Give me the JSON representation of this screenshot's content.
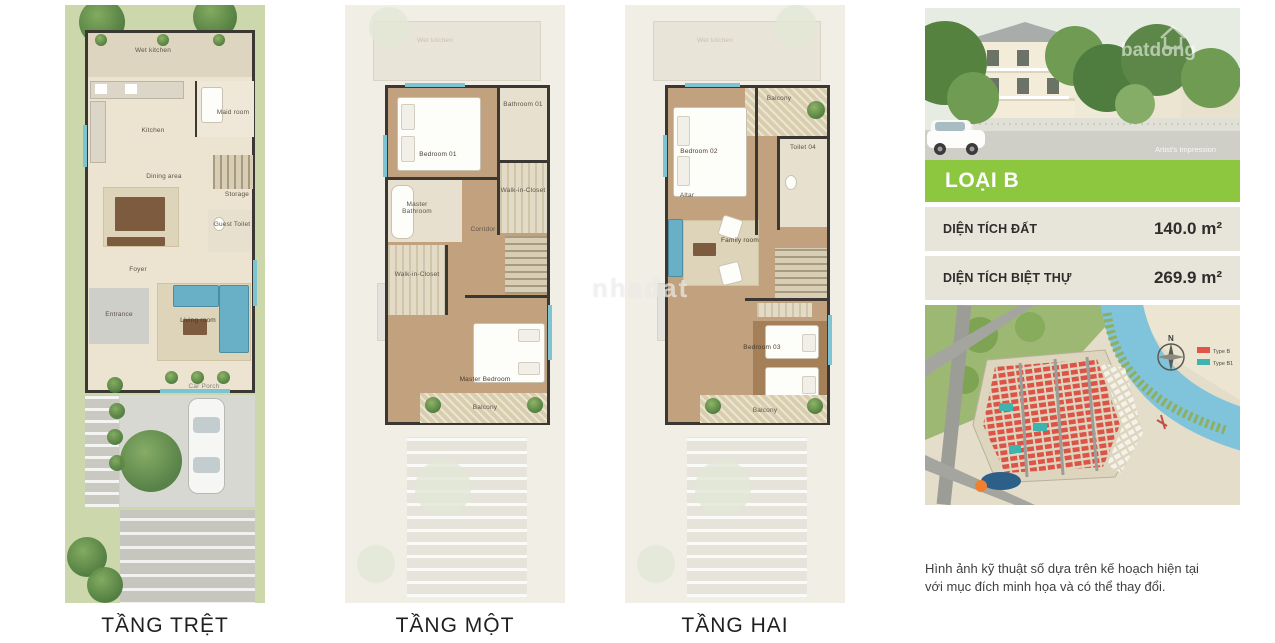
{
  "floors": [
    {
      "label": "TẦNG TRỆT",
      "rooms": {
        "wet_kitchen": "Wet kitchen",
        "maid_room": "Maid room",
        "kitchen": "Kitchen",
        "dining": "Dining area",
        "storage": "Storage",
        "guest_toilet": "Guest Toilet",
        "foyer": "Foyer",
        "entrance": "Entrance",
        "living": "Living room",
        "car_porch": "Car Porch"
      }
    },
    {
      "label": "TẦNG MỘT",
      "ghosts": {
        "wet_kitchen": "Wet kitchen",
        "entrance": "Entrance"
      },
      "rooms": {
        "bedroom01": "Bedroom 01",
        "bathroom01": "Bathroom 01",
        "wic_right": "Walk-in-Closet",
        "master_bath": "Master Bathroom",
        "wic_left": "Walk-in-Closet",
        "corridor": "Corridor",
        "master_bedroom": "Master Bedroom",
        "balcony": "Balcony"
      }
    },
    {
      "label": "TẦNG HAI",
      "ghosts": {
        "wet_kitchen": "Wet kitchen",
        "entrance": "Entrance"
      },
      "rooms": {
        "bedroom02": "Bedroom 02",
        "balcony_top": "Balcony",
        "toilet04": "Toilet 04",
        "altar": "Altar",
        "family": "Family room",
        "bedroom03": "Bedroom 03",
        "balcony_bottom": "Balcony"
      }
    }
  ],
  "watermark_center": "nhadat",
  "sidebar": {
    "photo": {
      "watermark": "batdong",
      "caption": "Artist's Impression"
    },
    "type_title": "LOẠI B",
    "specs": [
      {
        "label": "DIỆN TÍCH ĐẤT",
        "value": "140.0 m²"
      },
      {
        "label": "DIỆN TÍCH BIỆT THỰ",
        "value": "269.9 m²"
      }
    ],
    "siteplan": {
      "compass": "N",
      "legend": [
        {
          "label": "Type B",
          "color": "#e05548"
        },
        {
          "label": "Type B1",
          "color": "#3fb3ad"
        }
      ]
    },
    "disclaimer_line1": "Hình ảnh kỹ thuật số dựa trên kế hoạch hiện tại",
    "disclaimer_line2": "với mục đích minh họa và có thể thay đổi."
  },
  "colors": {
    "accent_green": "#8dc63f",
    "spec_row_bg": "#e7e4da"
  }
}
